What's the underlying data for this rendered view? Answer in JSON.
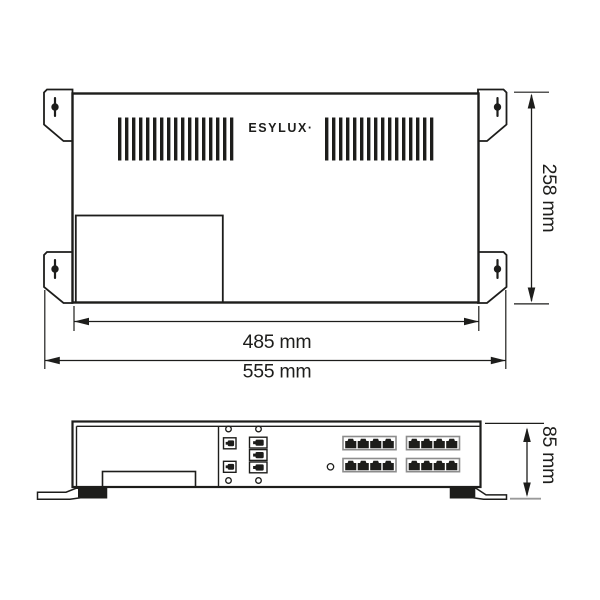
{
  "brand": {
    "logo_text": "ESYLUX·"
  },
  "dimensions": {
    "body_width": {
      "label": "485 mm"
    },
    "overall_width": {
      "label": "555 mm"
    },
    "depth": {
      "label": "258 mm"
    },
    "height": {
      "label": "85 mm"
    }
  },
  "colors": {
    "line": "#1d1d1b",
    "tick": "#9a9a9a",
    "port_frame": "#8c8c8c",
    "background": "#ffffff"
  },
  "features": {
    "mounting_tabs": 4,
    "vent_slats_left": 17,
    "vent_slats_right": 16,
    "rj45_banks": 4,
    "rj45_ports_per_bank": 4,
    "aux_ports": 5,
    "screw_holes": 4,
    "feet": 2
  }
}
